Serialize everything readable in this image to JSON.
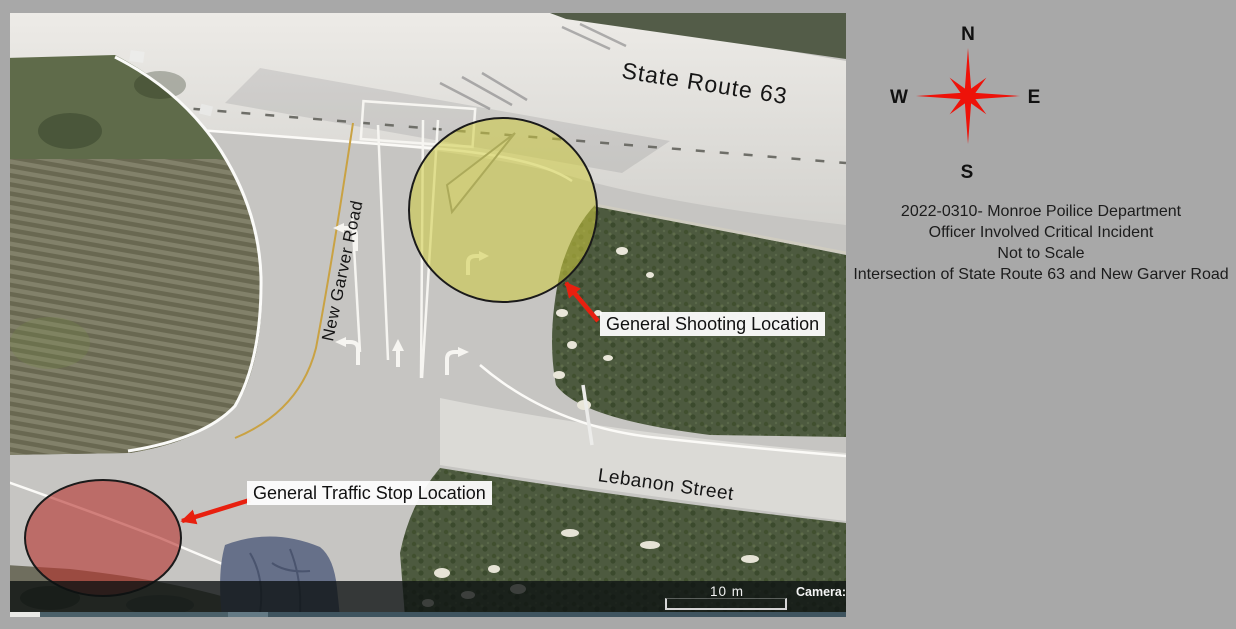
{
  "map": {
    "street_labels": [
      {
        "text": "State Route 63"
      },
      {
        "text": "New Garver Road"
      },
      {
        "text": "Lebanon Street"
      }
    ],
    "annotations": [
      {
        "label": "General Shooting Location",
        "marker": "yellow-circle",
        "marker_fill": "rgba(206,203,62,0.55)",
        "arrow_color": "#e8200f"
      },
      {
        "label": "General Traffic Stop Location",
        "marker": "red-ellipse",
        "marker_fill": "rgba(182,53,48,0.62)",
        "arrow_color": "#e8200f"
      }
    ],
    "scale_bar_label": "10 m",
    "camera_label": "Camera:"
  },
  "panel": {
    "compass": {
      "color": "#ee1209",
      "north": "N",
      "east": "E",
      "south": "S",
      "west": "W"
    },
    "case_lines": [
      "2022-0310- Monroe Poilice Department",
      "Officer Involved Critical Incident",
      "Not to Scale",
      "Intersection of State Route 63 and New Garver Road"
    ]
  }
}
